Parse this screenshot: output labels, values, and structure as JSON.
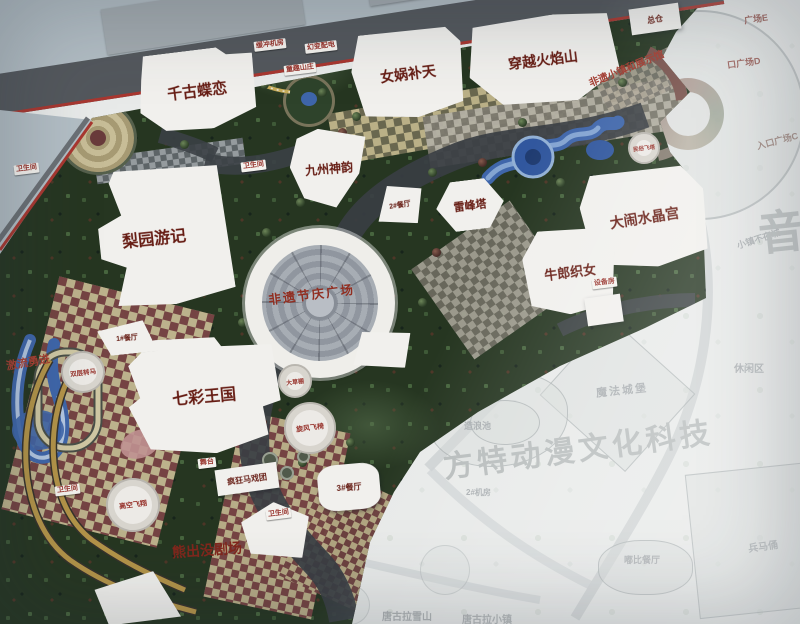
{
  "attractions": {
    "qiangu": "千古蝶恋",
    "nvwa": "女娲补天",
    "huoyanshan": "穿越火焰山",
    "jiuzhou": "九州神韵",
    "leifengta": "雷峰塔",
    "shuijinggong": "大闹水晶宫",
    "niulang": "牛郎织女",
    "liyuan": "梨园游记",
    "feiyi_plaza": "非遗节庆广场",
    "qicai": "七彩王国",
    "xiongchumo": "熊出没剧场",
    "feiyi_street": "非遗小镇和展示馆",
    "jiliu": "激流勇进"
  },
  "facilities": {
    "huanchong": "缓冲机房",
    "huanbian": "幻变配电",
    "tongqu": "童趣山庄",
    "wc": "卫生间",
    "canting1": "1#餐厅",
    "canting2": "2#餐厅",
    "canting3": "3#餐厅",
    "wutai": "舞台",
    "gaokong": "高空飞翔",
    "maxituan": "疯狂马戏团",
    "zhuanma": "双层转马",
    "xuanfeng": "旋风飞椅",
    "dacaopeng": "大草棚",
    "zongcang": "总仓",
    "feita": "民俗飞塔",
    "shebeifang": "设备房"
  },
  "entrance": {
    "plaza_e": "广场E",
    "plaza_d": "口广场D",
    "plaza_c": "入口广场C"
  },
  "faded_area": {
    "chuwu": "储物间",
    "mofa": "魔法城堡",
    "xiuxian": "休闲区",
    "bingmayong": "兵马俑",
    "dubi": "嘟比餐厅",
    "zaolang": "造浪池",
    "piaoliu": "漂流河",
    "canting4": "4#餐厅",
    "jifang2": "2#机房",
    "buye": "小镇不夜城",
    "xueshan": "唐古拉雪山",
    "xiaozhen": "唐古拉小镇",
    "watermark": "方特动漫文化科技",
    "yin": "音"
  },
  "colors": {
    "boundary_red": "#b5342c",
    "label_red": "#6e1a10",
    "pill_red": "#a3322a",
    "water_blue": "#3a66b4",
    "park_green": "#24371f",
    "faint_grey": "#a9aeb1"
  }
}
